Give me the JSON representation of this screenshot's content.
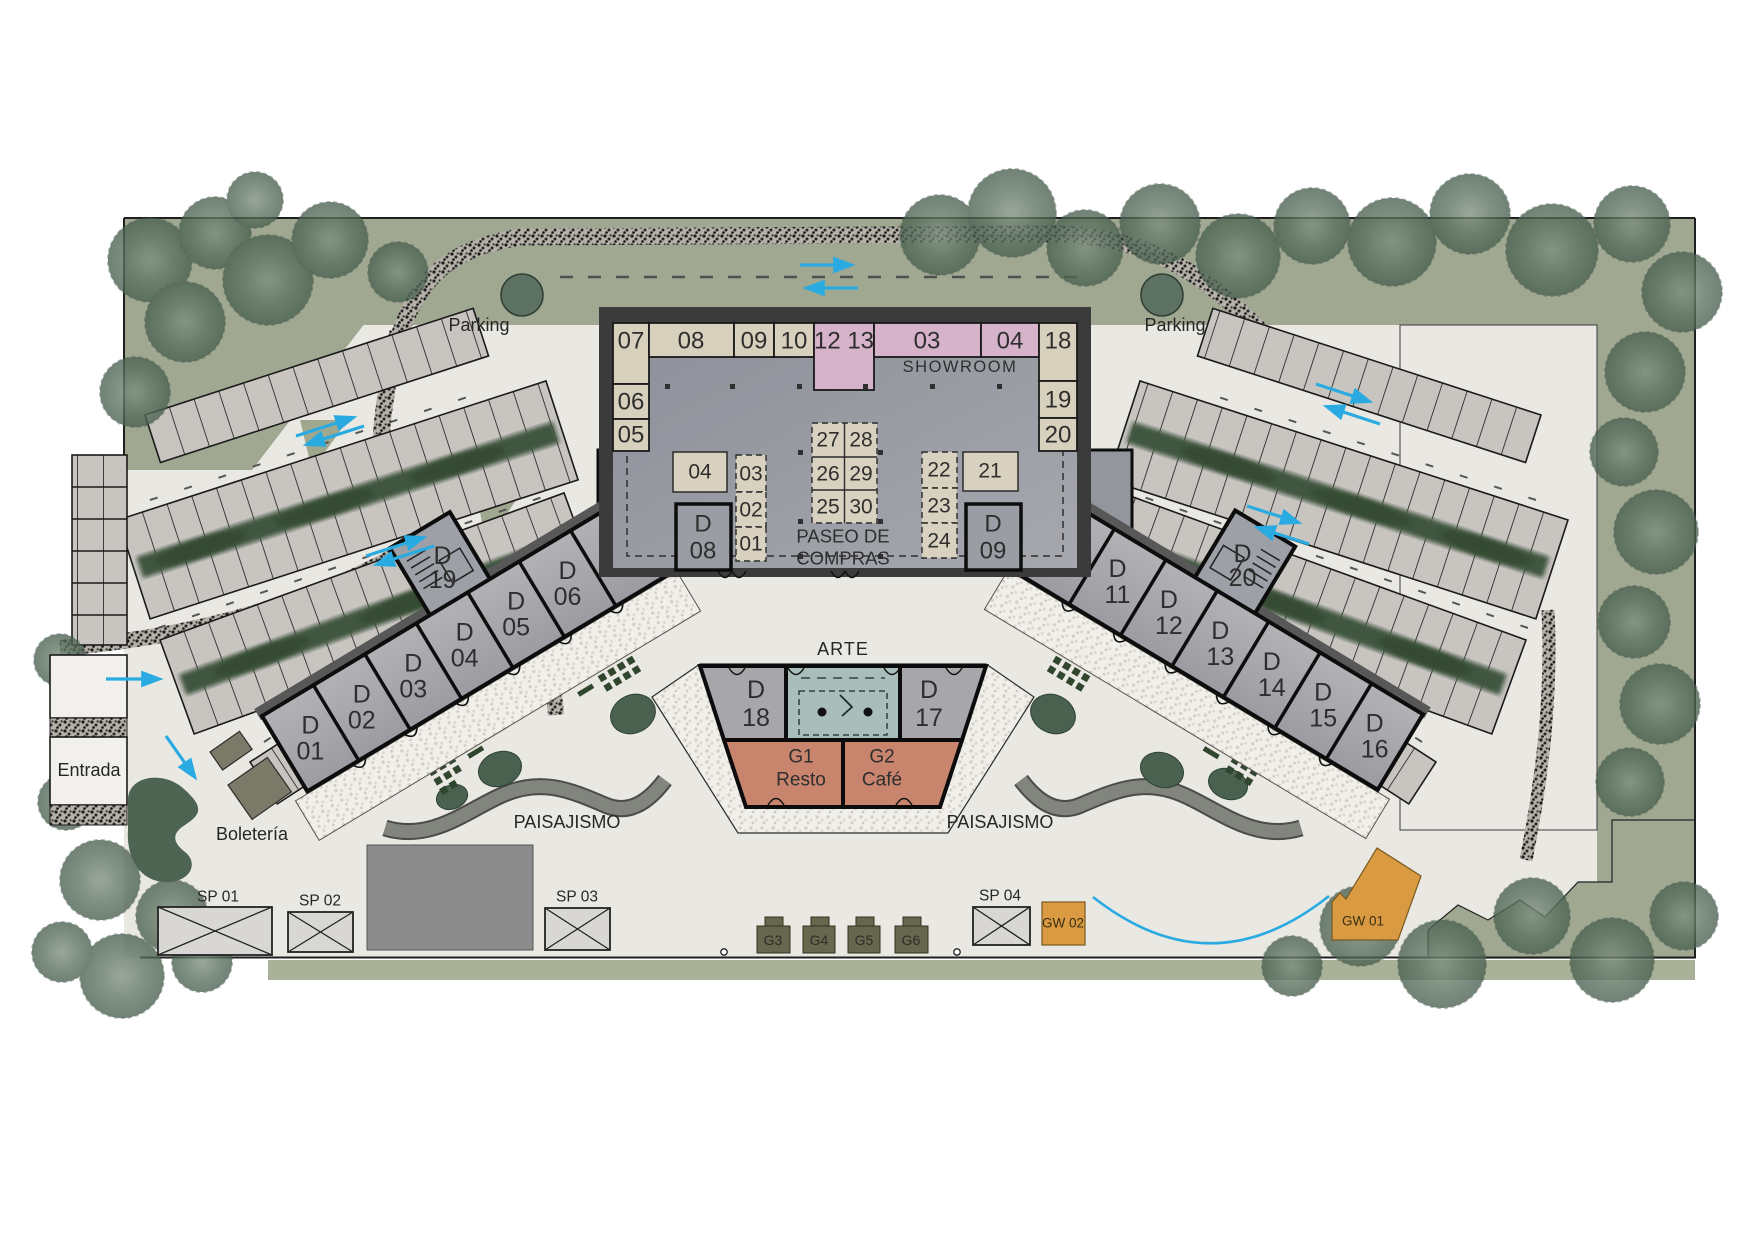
{
  "labels": {
    "parking_left": "Parking",
    "parking_right": "Parking",
    "showroom": "SHOWROOM",
    "paseo_line1": "PASEO DE",
    "paseo_line2": "COMPRAS",
    "arte": "ARTE",
    "paisajismo_left": "PAISAJISMO",
    "paisajismo_right": "PAISAJISMO",
    "entrada": "Entrada",
    "boleteria": "Boletería"
  },
  "building": {
    "top_cells": [
      {
        "label": "07"
      },
      {
        "label": "08"
      },
      {
        "label": "09"
      },
      {
        "label": "10"
      },
      {
        "label": "12 13"
      },
      {
        "label": "03"
      },
      {
        "label": "04"
      },
      {
        "label": "18"
      }
    ],
    "left_cells": [
      {
        "label": "06"
      },
      {
        "label": "05"
      }
    ],
    "right_cells": [
      {
        "label": "19"
      },
      {
        "label": "20"
      }
    ],
    "kiosks_left": [
      {
        "label": "04"
      },
      {
        "label": "03"
      },
      {
        "label": "02"
      },
      {
        "label": "01"
      }
    ],
    "kiosk_grid": [
      {
        "label": "27"
      },
      {
        "label": "28"
      },
      {
        "label": "26"
      },
      {
        "label": "29"
      },
      {
        "label": "25"
      },
      {
        "label": "30"
      }
    ],
    "kiosks_right": [
      {
        "label": "22"
      },
      {
        "label": "23"
      },
      {
        "label": "24"
      },
      {
        "label": "21"
      }
    ],
    "unit_d08": {
      "line1": "D",
      "line2": "08"
    },
    "unit_d09": {
      "line1": "D",
      "line2": "09"
    }
  },
  "wings": {
    "left": {
      "units": [
        {
          "line1": "D",
          "line2": "01"
        },
        {
          "line1": "D",
          "line2": "02"
        },
        {
          "line1": "D",
          "line2": "03"
        },
        {
          "line1": "D",
          "line2": "04"
        },
        {
          "line1": "D",
          "line2": "05"
        },
        {
          "line1": "D",
          "line2": "06"
        },
        {
          "line1": "D",
          "line2": "07"
        }
      ],
      "stair_unit": {
        "line1": "D",
        "line2": "19"
      }
    },
    "right": {
      "units": [
        {
          "line1": "D",
          "line2": "10"
        },
        {
          "line1": "D",
          "line2": "11"
        },
        {
          "line1": "D",
          "line2": "12"
        },
        {
          "line1": "D",
          "line2": "13"
        },
        {
          "line1": "D",
          "line2": "14"
        },
        {
          "line1": "D",
          "line2": "15"
        },
        {
          "line1": "D",
          "line2": "16"
        }
      ],
      "stair_unit": {
        "line1": "D",
        "line2": "20"
      }
    }
  },
  "pavilion": {
    "unit_d18": {
      "line1": "D",
      "line2": "18"
    },
    "unit_d17": {
      "line1": "D",
      "line2": "17"
    },
    "g1": {
      "id": "G1",
      "name": "Resto"
    },
    "g2": {
      "id": "G2",
      "name": "Café"
    }
  },
  "site": {
    "sp_pads": [
      {
        "label": "SP 01"
      },
      {
        "label": "SP 02"
      },
      {
        "label": "SP 03"
      },
      {
        "label": "SP 04"
      }
    ],
    "g_boxes": [
      {
        "label": "G3"
      },
      {
        "label": "G4"
      },
      {
        "label": "G5"
      },
      {
        "label": "G6"
      }
    ],
    "gw_units": [
      {
        "label": "GW 02"
      },
      {
        "label": "GW 01"
      }
    ]
  },
  "colors": {
    "accent_blue": "#29ABE2",
    "cell_beige": "#D7D0BD",
    "cell_pink": "#D6B3CB",
    "resto_salmon": "#C8846D",
    "arte_teal": "#A9BEBB",
    "gw_orange": "#D99A41",
    "sage_green": "#A0A892",
    "hedge_green": "#3E5440",
    "ground": "#EAE8E2"
  }
}
